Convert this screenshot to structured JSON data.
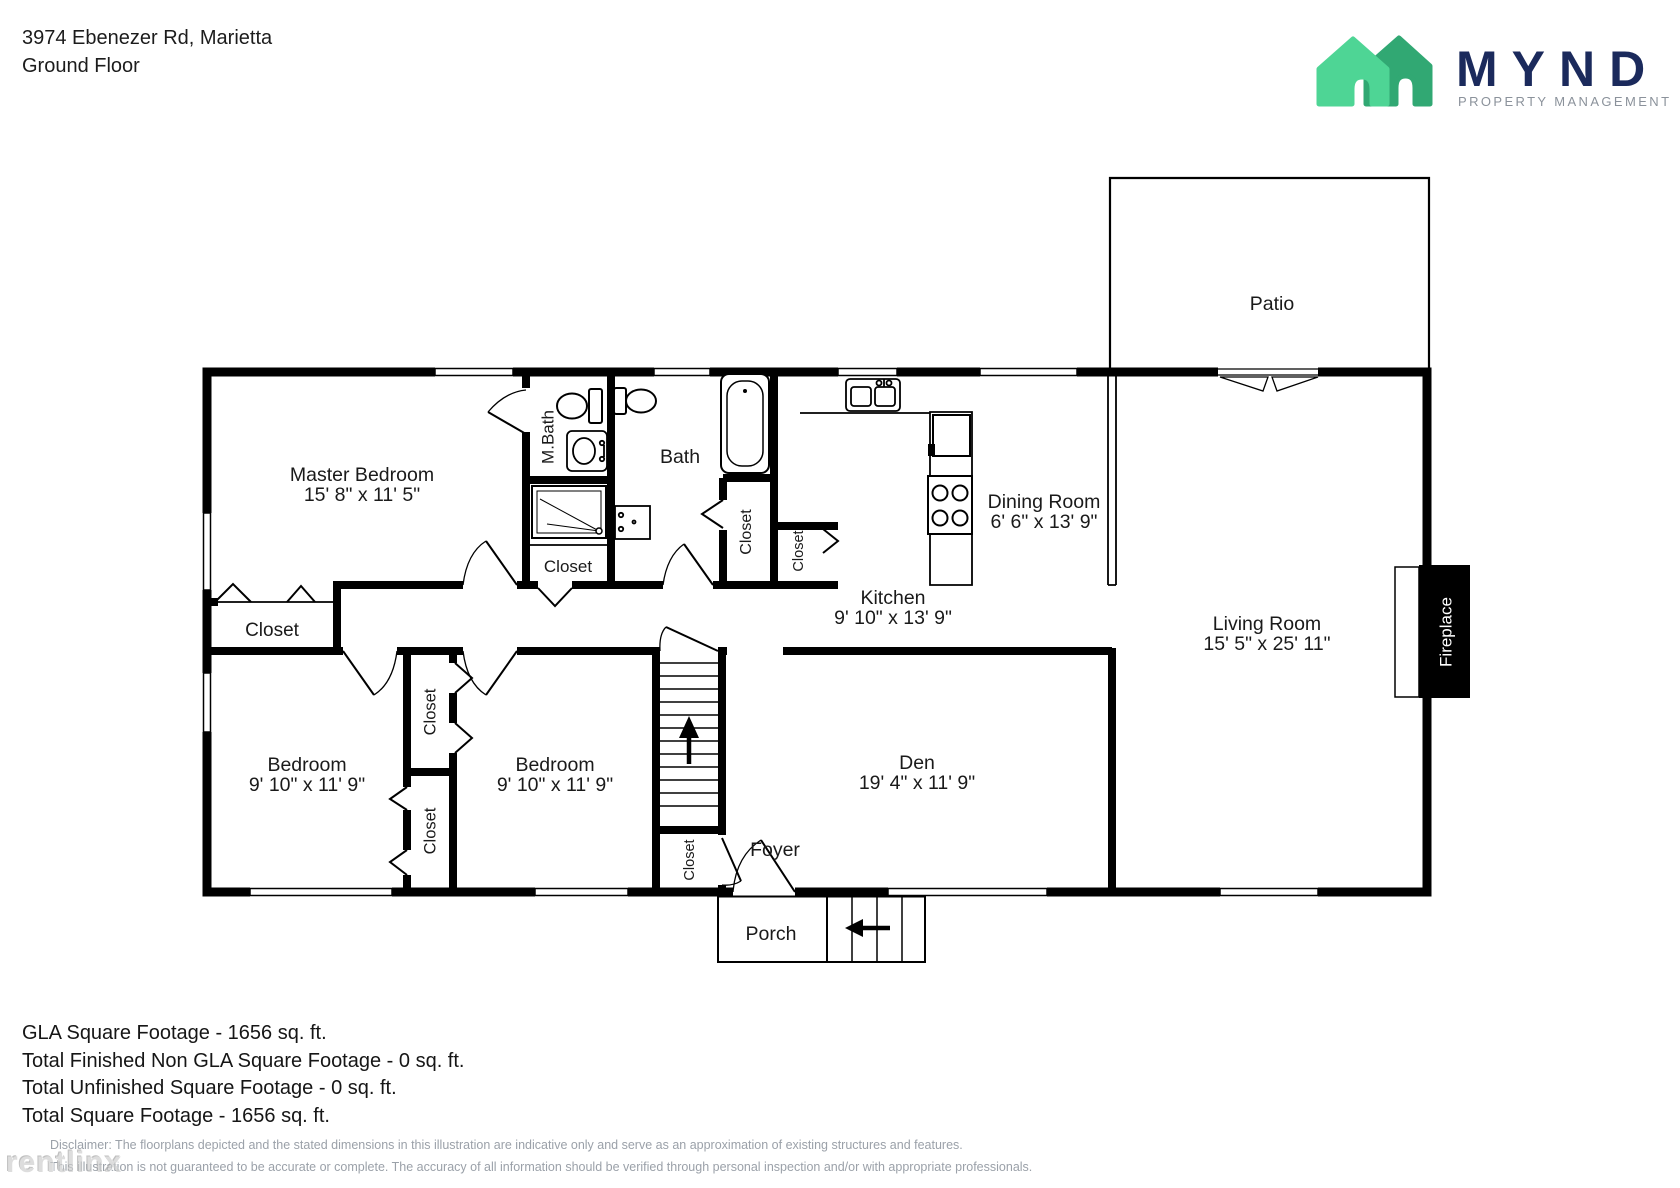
{
  "header": {
    "address": "3974 Ebenezer Rd, Marietta",
    "floor": "Ground Floor"
  },
  "logo": {
    "wordmark": "MYND",
    "tagline": "PROPERTY MANAGEMENT",
    "house_front_color": "#4ed595",
    "house_back_color": "#31a873",
    "wordmark_color": "#1b2a5c",
    "tagline_color": "#8b929b"
  },
  "floorplan": {
    "labels": {
      "closet": "Closet"
    },
    "rooms": {
      "master": {
        "name": "Master Bedroom",
        "dims": "15' 8\" x 11' 5\""
      },
      "mbath": {
        "name": "M.Bath"
      },
      "bath": {
        "name": "Bath"
      },
      "kitchen": {
        "name": "Kitchen",
        "dims": "9' 10\" x 13' 9\""
      },
      "dining": {
        "name": "Dining Room",
        "dims": "6' 6\" x 13' 9\""
      },
      "living": {
        "name": "Living Room",
        "dims": "15' 5\" x 25' 11\""
      },
      "den": {
        "name": "Den",
        "dims": "19' 4\" x 11' 9\""
      },
      "bedroom1": {
        "name": "Bedroom",
        "dims": "9' 10\" x 11' 9\""
      },
      "bedroom2": {
        "name": "Bedroom",
        "dims": "9' 10\" x 11' 9\""
      },
      "patio": {
        "name": "Patio"
      },
      "porch": {
        "name": "Porch"
      },
      "foyer": {
        "name": "Foyer"
      },
      "fireplace": {
        "name": "Fireplace"
      }
    }
  },
  "summary": {
    "lines": [
      "GLA Square Footage - 1656 sq. ft.",
      "Total Finished Non GLA Square Footage - 0 sq. ft.",
      "Total Unfinished Square Footage - 0 sq. ft.",
      "Total Square Footage - 1656 sq. ft."
    ]
  },
  "disclaimer": {
    "line1": "Disclaimer: The floorplans depicted and the stated dimensions in this illustration are indicative only and serve as an approximation of existing structures and features.",
    "line2": "This illustration is not guaranteed to be accurate or complete. The accuracy of all information should be verified through personal inspection and/or with appropriate professionals."
  },
  "watermark": {
    "text": "rentlinx"
  }
}
